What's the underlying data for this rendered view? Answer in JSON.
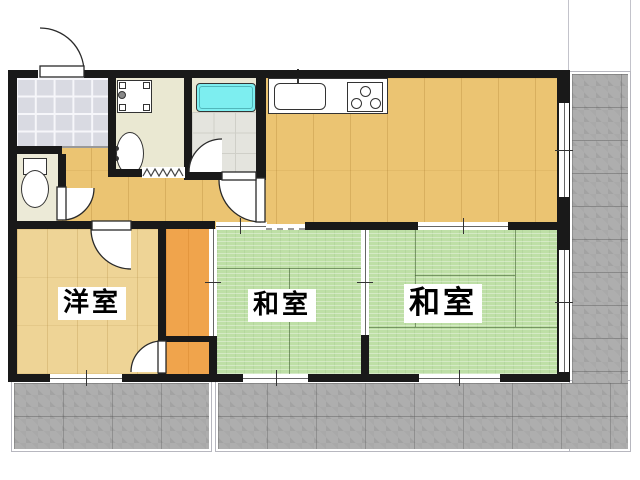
{
  "floor_plan": {
    "type": "japanese-apartment-madori",
    "rooms": [
      {
        "name": "western-room",
        "label": "洋室"
      },
      {
        "name": "japanese-room-small",
        "label": "和室"
      },
      {
        "name": "japanese-room-large",
        "label": "和室"
      }
    ],
    "unlabeled_areas": [
      "genkan-entrance",
      "hallway",
      "washroom",
      "bathroom",
      "toilet",
      "kitchen-dining",
      "closet",
      "balcony"
    ],
    "fixtures": [
      "entrance-door",
      "washing-machine-pan",
      "washbasin",
      "bathtub",
      "toilet-bowl",
      "kitchen-sink",
      "stove-3-burner",
      "accordion-door",
      "sliding-fusuma",
      "sliding-windows",
      "hinged-doors"
    ],
    "colors": {
      "wall": "#191919",
      "wood_floor": "#ebc472",
      "western_room_floor": "#eed496",
      "tatami": "#bedfa6",
      "closet": "#f0a44c",
      "balcony": "#aeaeae",
      "bathtub": "#7deef0",
      "entrance_tile": "#d9dae2"
    }
  }
}
